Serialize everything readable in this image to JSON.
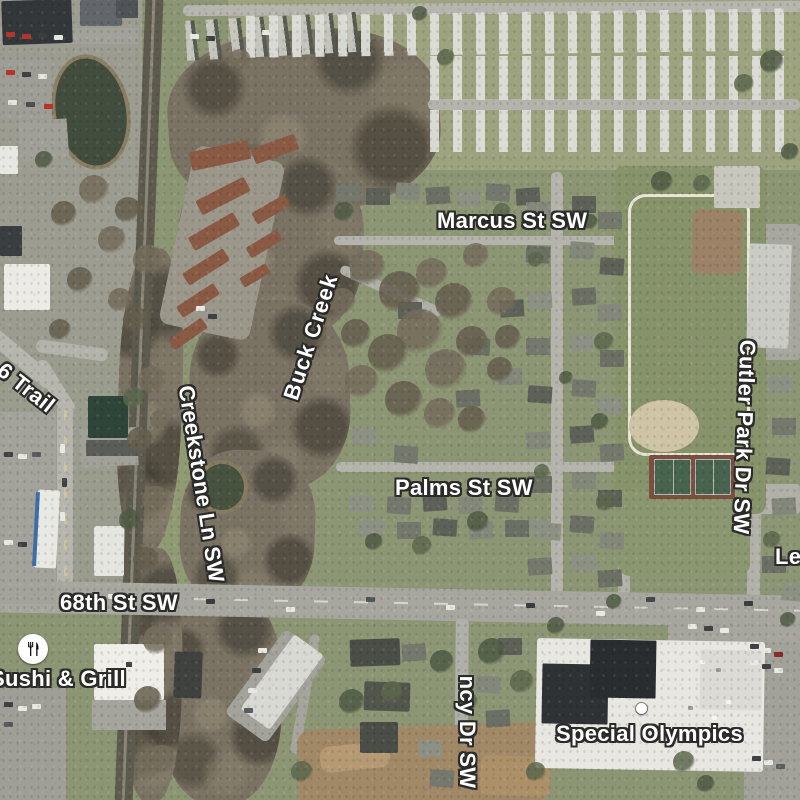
{
  "map": {
    "street_labels": {
      "marcus": "Marcus St SW",
      "palms": "Palms St SW",
      "sixty_eighth": "68th St SW",
      "creekstone": "Creekstone Ln SW",
      "cutler_park": "Cutler Park Dr SW",
      "trail": "6 Trail",
      "ncy": "ncy Dr SW",
      "le": "Le"
    },
    "water_labels": {
      "buck_creek": "Buck Creek"
    },
    "pois": {
      "sushi": {
        "name": "Sushi & Grill",
        "icon": "restaurant-utensils"
      },
      "special_olympics": {
        "name": "Special Olympics",
        "icon": "white-dot"
      }
    },
    "colors": {
      "label_text": "#ffffff",
      "label_outline": "#2a2a28",
      "road": "#b4b4ac",
      "major_road": "#a7a7a0",
      "grass": "#8d9674",
      "park_grass": "#87936a",
      "woods": "#7a7263",
      "water": "#424d3e",
      "infield_dirt": "#cfc5a6",
      "tennis_court": "#48644f",
      "storage_roof": "#8a5a44"
    }
  }
}
